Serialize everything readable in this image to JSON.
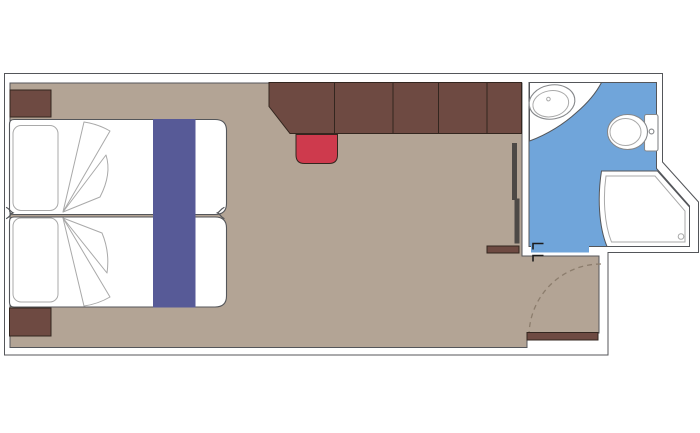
{
  "palette": {
    "outline": "#54565a",
    "wall": "#ffffff",
    "floor": "#b3a495",
    "wood": "#6e4a42",
    "wood_edge": "#33261f",
    "stool_red": "#ce3a4d",
    "runner_blue": "#575a97",
    "bath_blue": "#70a5da",
    "fixture_line": "#85878a",
    "fixture_line_light": "#a9a9a9",
    "mirror_dark": "#4d4946",
    "door_arc": "#8c7d6d",
    "door_mark": "#1c1c1c"
  },
  "floorplan": {
    "type": "cruise-cabin-floor-plan",
    "rooms": [
      "cabin",
      "bathroom"
    ],
    "symbols": [
      "double-bed",
      "pillows",
      "bed-runner",
      "blanket-folds",
      "seam-markers",
      "nightstand-top",
      "nightstand-bottom",
      "wardrobe-units",
      "stool",
      "mirror-panels",
      "entry-shelf",
      "washbasin",
      "toilet",
      "shower",
      "entry-door-leaf",
      "door-swing-arc",
      "bathroom-door-marks"
    ]
  }
}
